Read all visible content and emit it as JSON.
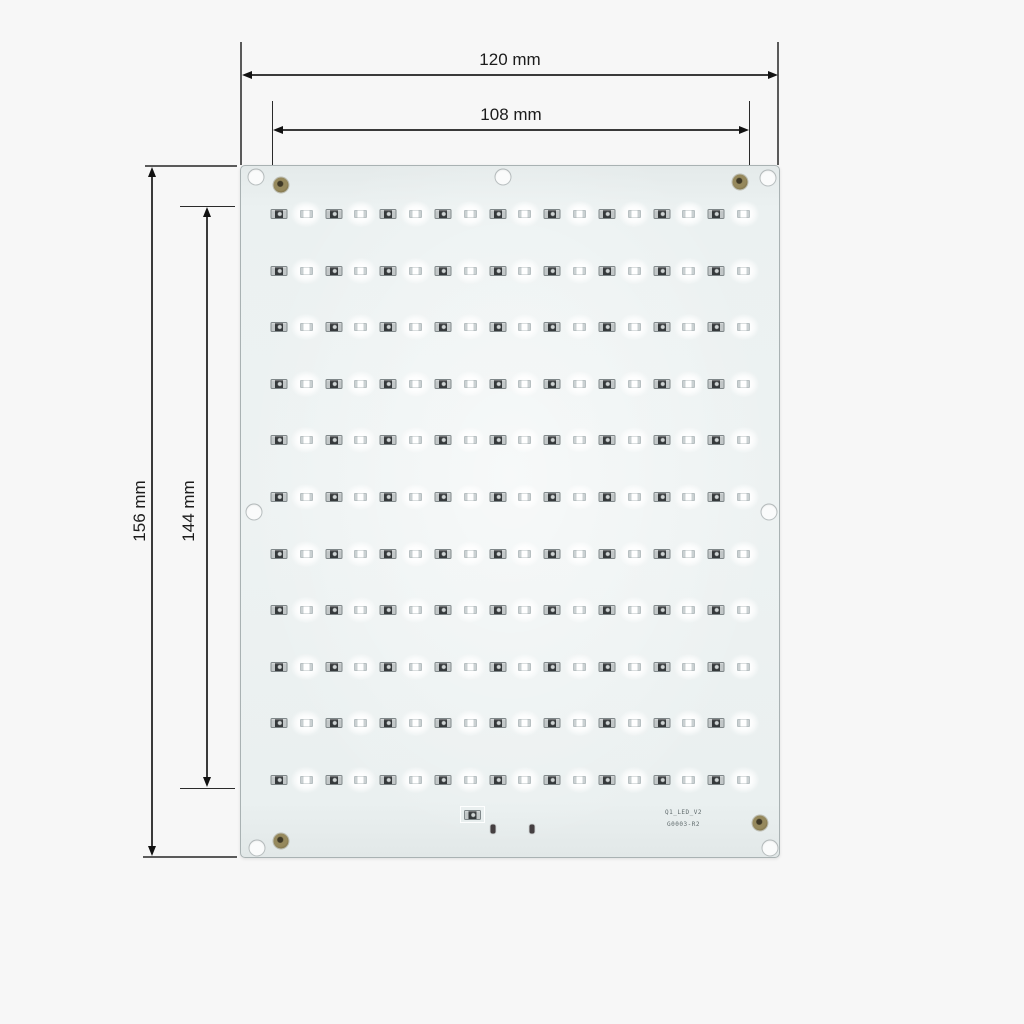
{
  "dimensions": {
    "outer_width": "120 mm",
    "inner_width": "108 mm",
    "outer_height": "156 mm",
    "inner_height": "144 mm"
  },
  "board": {
    "silkscreen": {
      "line1": "Q1_LED_V2",
      "line2": "G0003-R2"
    },
    "led_rows": 11,
    "led_pairs_per_row": 9,
    "mounting_hole_count": 7,
    "fiducial_count": 4,
    "colors": {
      "substrate": "#ebf1f1",
      "resistor_body": "#35393b",
      "resistor_terminal": "#c2c7c8",
      "fiducial_brass": "#8f8356",
      "dimension_ink": "#1c1c1c",
      "page_background": "#f7f7f7"
    }
  }
}
